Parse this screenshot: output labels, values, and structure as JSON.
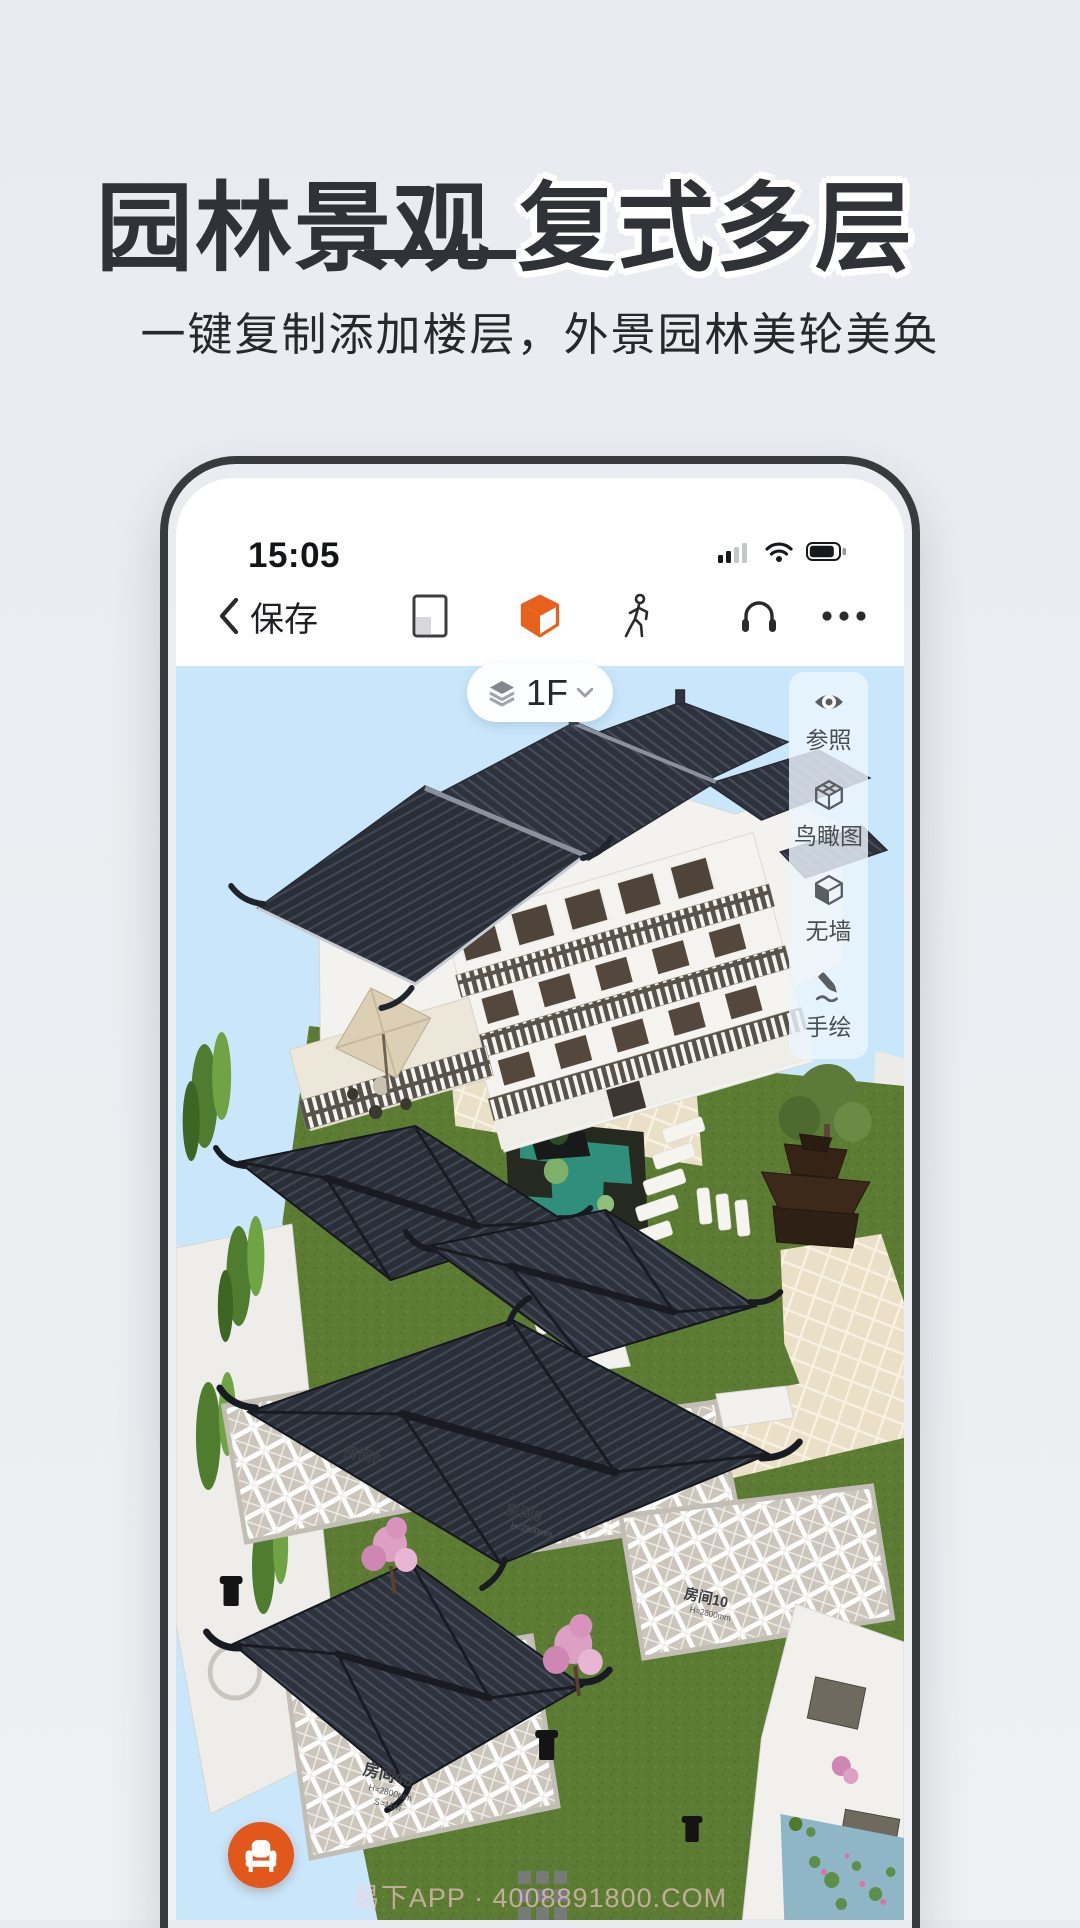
{
  "hero": {
    "title_part1": "园林景观",
    "title_part2": "复式多层",
    "subtitle": "一键复制添加楼层，外景园林美轮美奂"
  },
  "phone": {
    "status_bar": {
      "time": "15:05",
      "icons": [
        "signal-icon",
        "wifi-icon",
        "battery-icon"
      ]
    },
    "toolbar": {
      "back_label": "保存",
      "icons": [
        "back-chevron-icon",
        "floorplan-view-icon",
        "cube-3d-view-icon",
        "walkthrough-icon",
        "headset-icon",
        "more-dots-icon"
      ]
    },
    "floor_selector": {
      "current_floor": "1F",
      "icons": [
        "layers-icon",
        "chevron-down-icon"
      ]
    },
    "side_panel": {
      "items": [
        {
          "label": "参照",
          "icon": "eye-icon"
        },
        {
          "label": "鸟瞰图",
          "icon": "birdseye-cube-icon"
        },
        {
          "label": "无墙",
          "icon": "no-wall-cube-icon"
        },
        {
          "label": "手绘",
          "icon": "sketch-pencil-icon"
        }
      ]
    },
    "scene": {
      "room_labels": [
        {
          "name": "房间8"
        },
        {
          "name": "房间9",
          "height": "H=2800mm"
        },
        {
          "name": "房间10",
          "height": "H=2800mm"
        },
        {
          "name": "房间43",
          "height": "H=2800mm",
          "area": "S=11㎡"
        }
      ],
      "watermark": "易下APP · 4008891800.COM"
    },
    "fab": {
      "icon": "armchair-icon"
    },
    "colors": {
      "accent_orange": "#E8611C",
      "fab_orange": "#E2571B",
      "sky": "#C9E6FA",
      "grass": "#5C7B33",
      "roof_dark": "#2E323C"
    }
  }
}
